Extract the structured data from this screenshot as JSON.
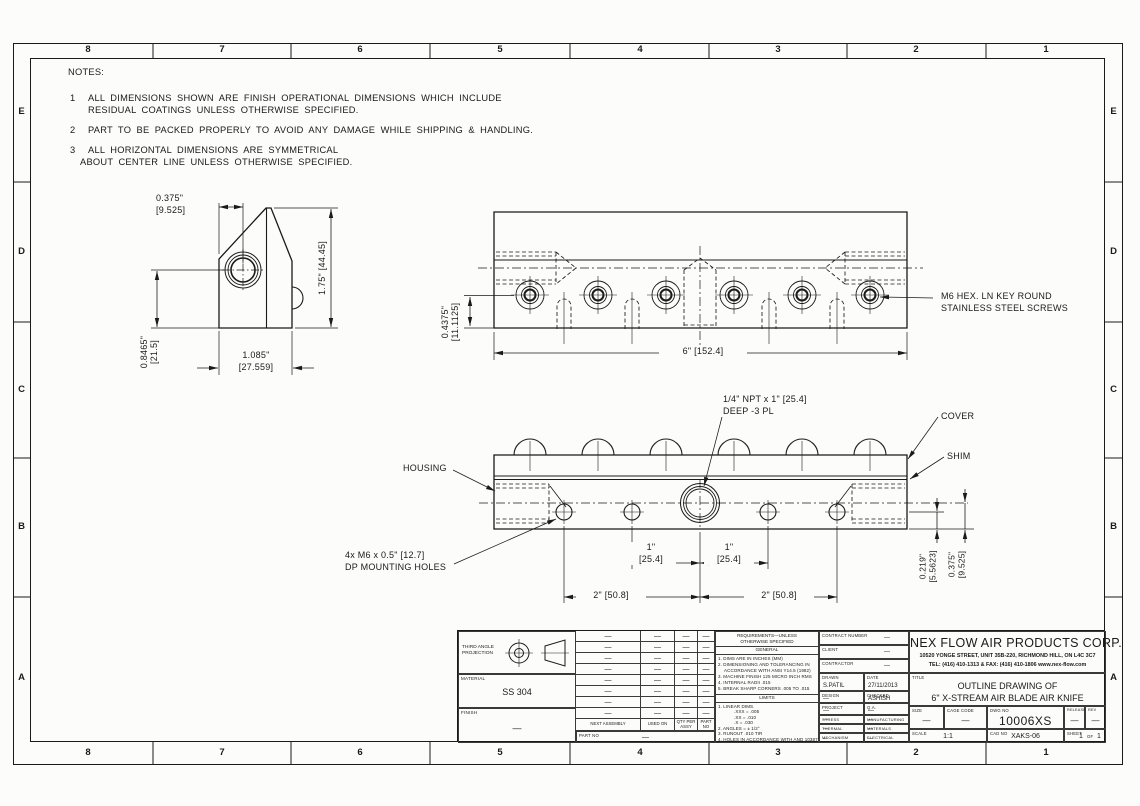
{
  "border": {
    "cols": [
      "8",
      "7",
      "6",
      "5",
      "4",
      "3",
      "2",
      "1"
    ],
    "rows": [
      "E",
      "D",
      "C",
      "B",
      "A"
    ]
  },
  "notes": {
    "heading": "NOTES:",
    "n1_num": "1",
    "n1_line1": "ALL DIMENSIONS SHOWN ARE FINISH OPERATIONAL DIMENSIONS WHICH INCLUDE",
    "n1_line2": "RESIDUAL COATINGS UNLESS OTHERWISE SPECIFIED.",
    "n2_num": "2",
    "n2_line1": "PART TO BE PACKED PROPERLY TO AVOID ANY DAMAGE WHILE SHIPPING & HANDLING.",
    "n3_num": "3",
    "n3_line1": "ALL HORIZONTAL DIMENSIONS ARE SYMMETRICAL",
    "n3_line2": "ABOUT CENTER LINE UNLESS OTHERWISE SPECIFIED."
  },
  "side_view": {
    "dim_width_in": "0.375\"",
    "dim_width_mm": "[9.525]",
    "dim_height": "1.75\" [44.45]",
    "dim_center_in": "0.8465\"",
    "dim_center_mm": "[21.5]",
    "dim_depth_in": "1.085\"",
    "dim_depth_mm": "[27.559]"
  },
  "top_view": {
    "dim_length": "6\" [152.4]",
    "dim_edge_in": "0.4375\"",
    "dim_edge_mm": "[11.1125]",
    "screw_note_line1": "M6 HEX. LN KEY ROUND",
    "screw_note_line2": "STAINLESS STEEL SCREWS"
  },
  "front_view": {
    "npt_line1": "1/4\" NPT x 1\" [25.4]",
    "npt_line2": "DEEP -3 PL",
    "cover_label": "COVER",
    "shim_label": "SHIM",
    "housing_label": "HOUSING",
    "mount_line1": "4x M6 x 0.5\" [12.7]",
    "mount_line2": "DP MOUNTING HOLES",
    "dim_1in": "1\"",
    "dim_1mm": "[25.4]",
    "dim_2": "2\" [50.8]",
    "dim_shim_in": "0.219\"",
    "dim_shim_mm": "[5.5623]",
    "dim_cover_in": "0.375\"",
    "dim_cover_mm": "[9.525]"
  },
  "title_block": {
    "projection_line1": "THIRD ANGLE",
    "projection_line2": "PROJECTION",
    "material_label": "MATERIAL",
    "material_value": "SS 304",
    "finish_label": "FINISH",
    "finish_value": "—",
    "dash": "—",
    "next_assembly_label": "NEXT ASSEMBLY",
    "used_on_label": "USED ON",
    "qty_line1": "QTY PER",
    "qty_line2": "ASSY",
    "part_no_label": "PART NO",
    "req": {
      "header_line1": "REQUIREMENTS—UNLESS",
      "header_line2": "OTHERWISE SPECIFIED",
      "general_label": "GENERAL",
      "g1": "1. DIMS ARE IN INCHES (MM)",
      "g2": "2. DIMENSIONING AND TOLERANCING IN",
      "g2b": "ACCORDANCE WITH ANSI Y14.5 (1982)",
      "g3": "3. MACHINE FINISH 125 MICRO INCH RMS",
      "g4": "4. INTERNAL RADII .015",
      "g5": "5. BREAK SHARP CORNERS .005 TO .015",
      "limits_label": "LIMITS",
      "l1": "1. LINEAR DIMS.",
      "l1a": ".XXX = .005",
      "l1b": ".XX = .010",
      "l1c": ".X = .030",
      "l2": "2. ANGLES = ± 1/2°",
      "l3": "3. RUNOUT .010 TIR",
      "l4": "4. HOLES IN ACCORDANCE WITH AND 10387"
    },
    "contract_label": "CONTRACT NUMBER",
    "client_label": "CLIENT",
    "contractor_label": "CONTRACTOR",
    "drawn_label": "DRAWN",
    "drawn_value": "S.PATIL",
    "date_label": "DATE",
    "date_value": "27/11/2013",
    "design_label": "DESIGN",
    "checked_label": "CHECKED",
    "checked_value": "ASHISH",
    "project_label": "PROJECT",
    "qa_label": "Q.A.",
    "stress_label": "STRESS",
    "manufacturing_label": "MANUFACTURING",
    "thermal_label": "THERMAL",
    "materials_label": "MATERIALS",
    "mechanism_label": "MECHANISM",
    "electrical_label": "ELECTRICAL",
    "company_name": "NEX FLOW AIR PRODUCTS CORP.",
    "company_address": "10520 YONGE STREET, UNIT 35B-220, RICHMOND HILL, ON L4C 3C7",
    "company_tel": "TEL: (416) 410-1313 & FAX: (416) 410-1806  www.nex-flow.com",
    "title_label": "TITLE",
    "title_line1": "OUTLINE DRAWING OF",
    "title_line2": "6\" X-STREAM AIR BLADE AIR KNIFE",
    "size_label": "SIZE",
    "cage_label": "CAGE CODE",
    "dwg_label": "DWG NO",
    "dwg_value": "10006XS",
    "release_label": "RELEASE",
    "rev_label": "REV",
    "scale_label": "SCALE",
    "scale_value": "1:1",
    "cad_label": "CAD NO",
    "cad_value": "XAKS-06",
    "sheet_label": "SHEET",
    "sheet_num": "1",
    "of_label": "OF",
    "sheet_total": "1"
  }
}
